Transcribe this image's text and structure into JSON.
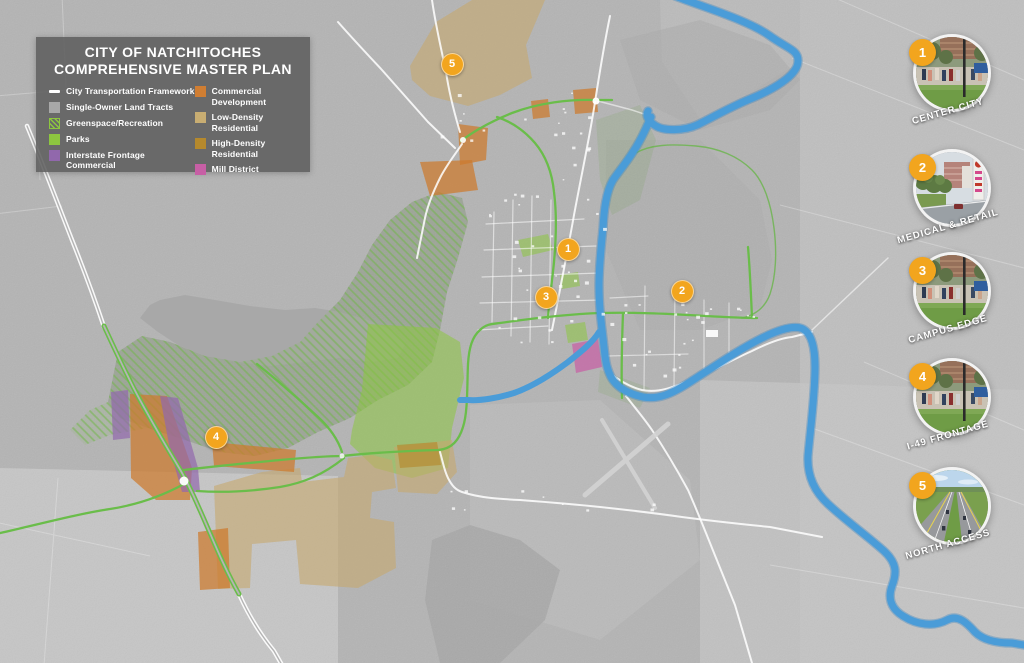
{
  "map": {
    "title_line1": "CITY OF NATCHITOCHES",
    "title_line2": "COMPREHENSIVE MASTER PLAN",
    "colors": {
      "marker": "#F2A51E",
      "river": "#4A9CD8",
      "road_green": "#6ABD4A",
      "transportation": "#FFFFFF",
      "tracts": "#A8A8A8",
      "greenspace": "#8DC63F",
      "parks": "#8DC63F",
      "interstate_frontage": "#9168AC",
      "commercial": "#D07E33",
      "low_density": "#C8AD72",
      "high_density": "#B5892D",
      "mill": "#C75FA5"
    },
    "legend": {
      "left": [
        {
          "label": "City Transportation Framework",
          "swatch": "line",
          "color": "#FFFFFF"
        },
        {
          "label": "Single-Owner Land Tracts",
          "swatch": "square",
          "color": "#A8A8A8"
        },
        {
          "label": "Greenspace/Recreation",
          "swatch": "hatch",
          "color": "#8DC63F"
        },
        {
          "label": "Parks",
          "swatch": "square",
          "color": "#8DC63F"
        },
        {
          "label": "Interstate Frontage Commercial",
          "swatch": "square",
          "color": "#9168AC"
        }
      ],
      "right": [
        {
          "label": "Commercial Development",
          "swatch": "square",
          "color": "#D07E33"
        },
        {
          "label": "Low-Density Residential",
          "swatch": "square",
          "color": "#C8AD72"
        },
        {
          "label": "High-Density Residential",
          "swatch": "square",
          "color": "#B5892D"
        },
        {
          "label": "Mill District",
          "swatch": "square",
          "color": "#C75FA5"
        }
      ]
    },
    "markers": [
      {
        "number": "1",
        "x": 568,
        "y": 249
      },
      {
        "number": "2",
        "x": 682,
        "y": 291
      },
      {
        "number": "3",
        "x": 546,
        "y": 297
      },
      {
        "number": "4",
        "x": 216,
        "y": 437
      },
      {
        "number": "5",
        "x": 452,
        "y": 64
      }
    ]
  },
  "callouts": [
    {
      "number": "1",
      "label": "CENTER CITY",
      "photo": "campus-street-scene"
    },
    {
      "number": "2",
      "label": "MEDICAL & RETAIL",
      "photo": "medical-retail-buildings"
    },
    {
      "number": "3",
      "label": "CAMPUS EDGE",
      "photo": "campus-street-scene"
    },
    {
      "number": "4",
      "label": "I-49 FRONTAGE",
      "photo": "campus-street-scene"
    },
    {
      "number": "5",
      "label": "NORTH ACCESS",
      "photo": "aerial-highway"
    }
  ]
}
